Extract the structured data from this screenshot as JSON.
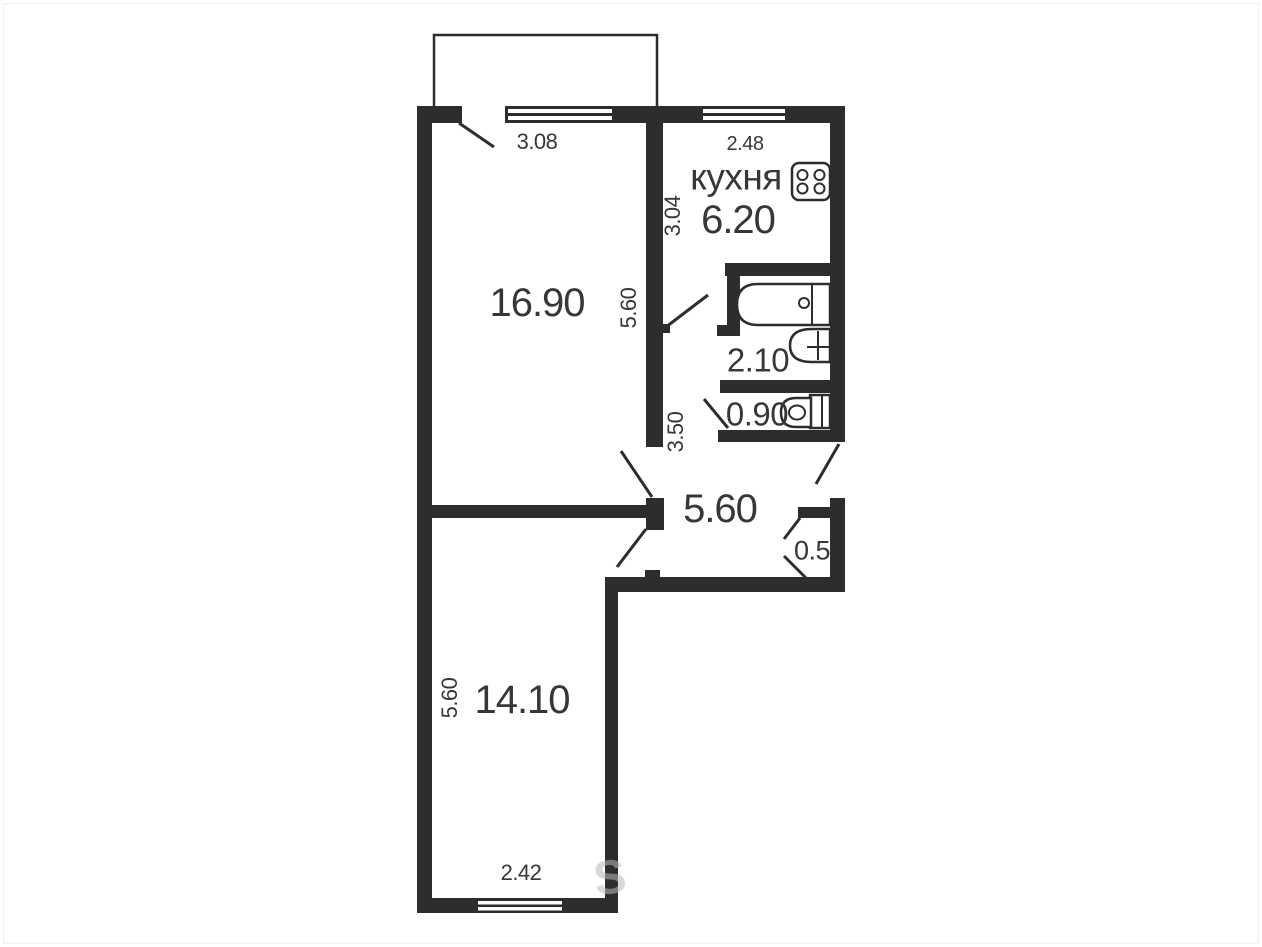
{
  "floor_plan": {
    "rooms": {
      "kitchen": {
        "name": "кухня",
        "area": "6.20",
        "width": "2.48",
        "depth": "3.04"
      },
      "living_room": {
        "area": "16.90",
        "width": "3.08",
        "depth": "5.60"
      },
      "bathroom": {
        "area": "2.10"
      },
      "wc": {
        "area": "0.90"
      },
      "hallway": {
        "area": "5.60",
        "corridor_depth": "3.50"
      },
      "closet": {
        "area": "0.5"
      },
      "bedroom": {
        "area": "14.10",
        "width": "2.42",
        "depth": "5.60"
      }
    },
    "icons": {
      "stove": "stove-icon",
      "bathtub": "bathtub-icon",
      "sink": "sink-icon",
      "toilet": "toilet-icon"
    },
    "colors": {
      "wall": "#2d2d2d",
      "text": "#373737",
      "background": "#ffffff"
    },
    "watermark": "S"
  }
}
